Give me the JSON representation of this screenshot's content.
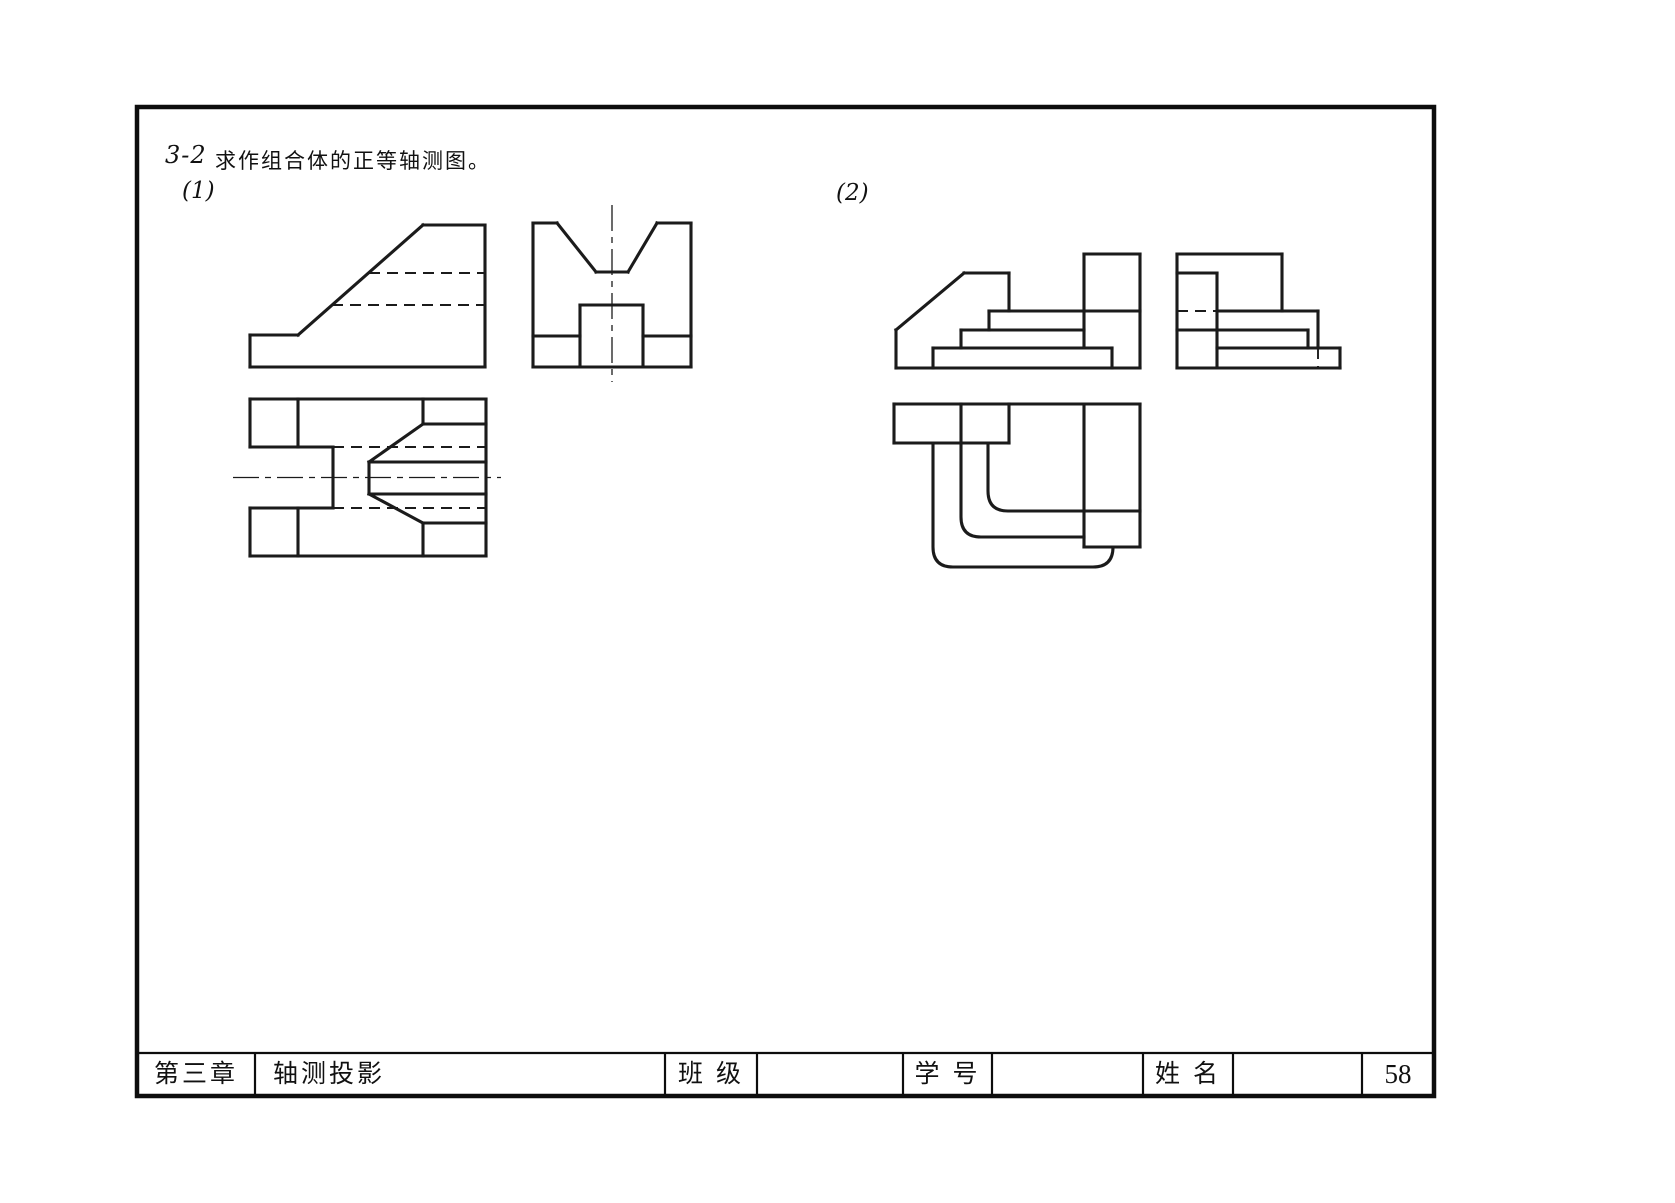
{
  "header": {
    "problem_number": "3-2",
    "problem_text": "求作组合体的正等轴测图。",
    "part1_label": "(1)",
    "part2_label": "(2)"
  },
  "title_block": {
    "chapter": "第三章",
    "course_title": "轴测投影",
    "class_label": "班 级",
    "student_id_label": "学 号",
    "name_label": "姓 名",
    "page_number": "58"
  },
  "colors": {
    "line": "#1b1b1b",
    "background": "#ffffff"
  },
  "frame": {
    "border": [
      137,
      107,
      1434,
      1096
    ],
    "table_y": 1053,
    "cols": [
      255,
      665,
      757,
      903,
      992,
      1143,
      1233,
      1362
    ]
  },
  "views": {
    "p1_front": {
      "solid": [
        [
          250,
          335,
          298,
          335
        ],
        [
          298,
          335,
          423,
          225
        ],
        [
          423,
          225,
          485,
          225
        ],
        [
          485,
          225,
          485,
          367
        ],
        [
          250,
          367,
          485,
          367
        ],
        [
          250,
          335,
          250,
          367
        ]
      ],
      "dashed": [
        [
          369,
          273,
          485,
          273
        ],
        [
          332,
          305,
          485,
          305
        ]
      ]
    },
    "p1_side": {
      "solid": [
        [
          533,
          223,
          557,
          223
        ],
        [
          557,
          223,
          596,
          272
        ],
        [
          596,
          272,
          628,
          272
        ],
        [
          628,
          272,
          657,
          223
        ],
        [
          657,
          223,
          691,
          223
        ],
        [
          691,
          223,
          691,
          367
        ],
        [
          533,
          367,
          691,
          367
        ],
        [
          533,
          223,
          533,
          367
        ],
        [
          580,
          305,
          643,
          305
        ],
        [
          580,
          305,
          580,
          367
        ],
        [
          643,
          305,
          643,
          367
        ],
        [
          533,
          336,
          580,
          336
        ],
        [
          643,
          336,
          691,
          336
        ]
      ],
      "center": [
        [
          612,
          205,
          612,
          382
        ]
      ]
    },
    "p1_top": {
      "solid": [
        [
          250,
          399,
          486,
          399
        ],
        [
          486,
          399,
          486,
          556
        ],
        [
          250,
          556,
          486,
          556
        ],
        [
          250,
          399,
          250,
          447
        ],
        [
          250,
          508,
          250,
          556
        ],
        [
          298,
          399,
          298,
          447
        ],
        [
          298,
          508,
          298,
          556
        ],
        [
          250,
          447,
          333,
          447
        ],
        [
          250,
          508,
          333,
          508
        ],
        [
          333,
          447,
          333,
          508
        ],
        [
          423,
          399,
          423,
          424
        ],
        [
          423,
          424,
          486,
          424
        ],
        [
          423,
          424,
          369,
          462
        ],
        [
          369,
          462,
          369,
          494
        ],
        [
          369,
          462,
          486,
          462
        ],
        [
          369,
          494,
          486,
          494
        ],
        [
          369,
          494,
          423,
          523
        ],
        [
          423,
          523,
          486,
          523
        ],
        [
          423,
          523,
          423,
          556
        ]
      ],
      "dashed": [
        [
          333,
          447,
          486,
          447
        ],
        [
          333,
          508,
          486,
          508
        ]
      ],
      "center": [
        [
          233,
          477.5,
          501,
          477.5
        ]
      ]
    },
    "p2_front": {
      "solid": [
        [
          896,
          330,
          896,
          368
        ],
        [
          896,
          330,
          964,
          273
        ],
        [
          964,
          273,
          1009,
          273
        ],
        [
          1009,
          273,
          1009,
          311
        ],
        [
          989,
          311,
          1140,
          311
        ],
        [
          989,
          311,
          989,
          330
        ],
        [
          961,
          330,
          1084,
          330
        ],
        [
          961,
          330,
          961,
          348
        ],
        [
          933,
          348,
          1112,
          348
        ],
        [
          933,
          348,
          933,
          368
        ],
        [
          896,
          368,
          1140,
          368
        ],
        [
          1112,
          348,
          1112,
          368
        ],
        [
          1084,
          254,
          1084,
          348
        ],
        [
          1084,
          254,
          1140,
          254
        ],
        [
          1140,
          254,
          1140,
          368
        ]
      ]
    },
    "p2_side": {
      "solid": [
        [
          1177,
          254,
          1177,
          368
        ],
        [
          1177,
          254,
          1282,
          254
        ],
        [
          1282,
          254,
          1282,
          311
        ],
        [
          1177,
          273,
          1217,
          273
        ],
        [
          1217,
          273,
          1217,
          368
        ],
        [
          1217,
          311,
          1318,
          311
        ],
        [
          1318,
          311,
          1318,
          348
        ],
        [
          1177,
          330,
          1308,
          330
        ],
        [
          1308,
          330,
          1308,
          348
        ],
        [
          1217,
          348,
          1340,
          348
        ],
        [
          1340,
          348,
          1340,
          368
        ],
        [
          1177,
          368,
          1340,
          368
        ]
      ],
      "dashed": [
        [
          1177,
          311,
          1217,
          311
        ],
        [
          1318,
          348,
          1318,
          368
        ]
      ]
    },
    "p2_top": {
      "solid": [
        [
          894,
          404,
          1140,
          404
        ],
        [
          894,
          404,
          894,
          443
        ],
        [
          894,
          443,
          1009,
          443
        ],
        [
          961,
          404,
          961,
          443
        ],
        [
          1009,
          404,
          1009,
          443
        ],
        [
          1084,
          404,
          1084,
          547
        ],
        [
          1140,
          404,
          1140,
          547
        ],
        [
          1084,
          547,
          1140,
          547
        ]
      ],
      "paths": [
        "M 933 443 L 933 547 Q 933 567 953 567 L 1093 567 Q 1113 567 1113 547",
        "M 961 443 L 961 517 Q 961 537 981 537 L 1084 537",
        "M 988 443 L 988 491 Q 988 511 1008 511 L 1140 511"
      ]
    }
  }
}
